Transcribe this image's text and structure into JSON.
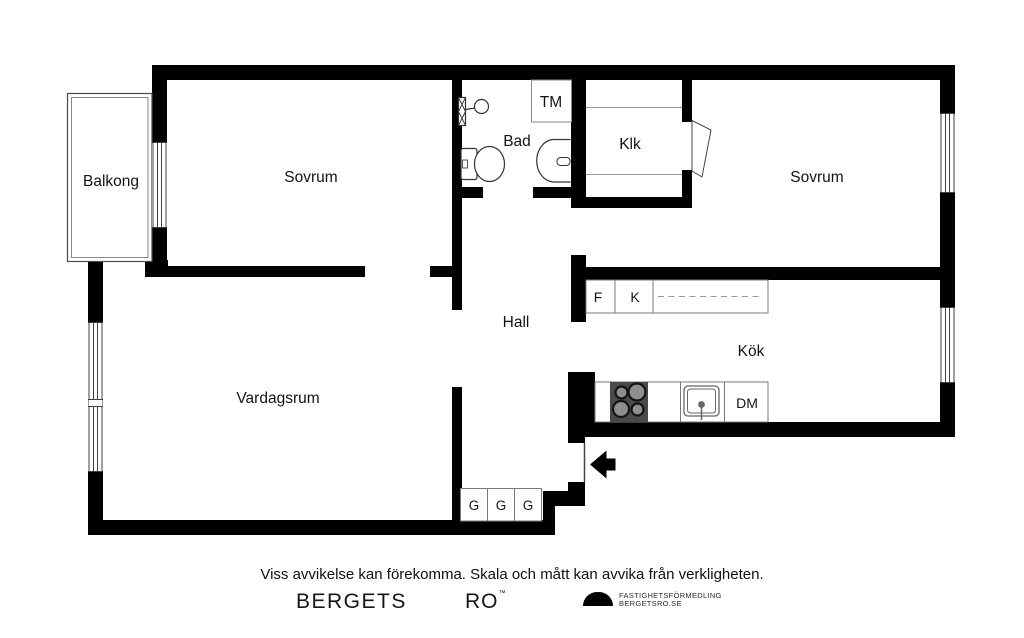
{
  "plan": {
    "rooms": {
      "balcony": "Balkong",
      "bedroom_left": "Sovrum",
      "bathroom": "Bad",
      "closet": "Klk",
      "bedroom_right": "Sovrum",
      "hall": "Hall",
      "kitchen": "Kök",
      "living_room": "Vardagsrum"
    },
    "units": {
      "washing_machine": "TM",
      "fridge": "F",
      "freezer": "K",
      "dishwasher": "DM",
      "wardrobes": [
        "G",
        "G",
        "G"
      ]
    },
    "icons": {
      "entrance": "entrance-arrow",
      "stove": "stove-four-burners",
      "kitchen_sink": "kitchen-sink",
      "toilet": "toilet",
      "washbasin": "washbasin",
      "shower": "shower",
      "closet_door": "door-leaf",
      "windows": "window-glazing-stripes"
    }
  },
  "footer": {
    "disclaimer": "Viss avvikelse kan förekomma. Skala och mått kan avvika från verkligheten.",
    "brand": {
      "word1": "BERGETS",
      "word2": "RO",
      "tm": "™",
      "tagline_line1": "FASTIGHETSFÖRMEDLING",
      "tagline_line2": "BERGETSRO.SE"
    }
  },
  "colors": {
    "wall": "#000000",
    "fixture_line": "#333333",
    "counter_line": "#7a7a7a",
    "stove": "#4a4a4a"
  }
}
